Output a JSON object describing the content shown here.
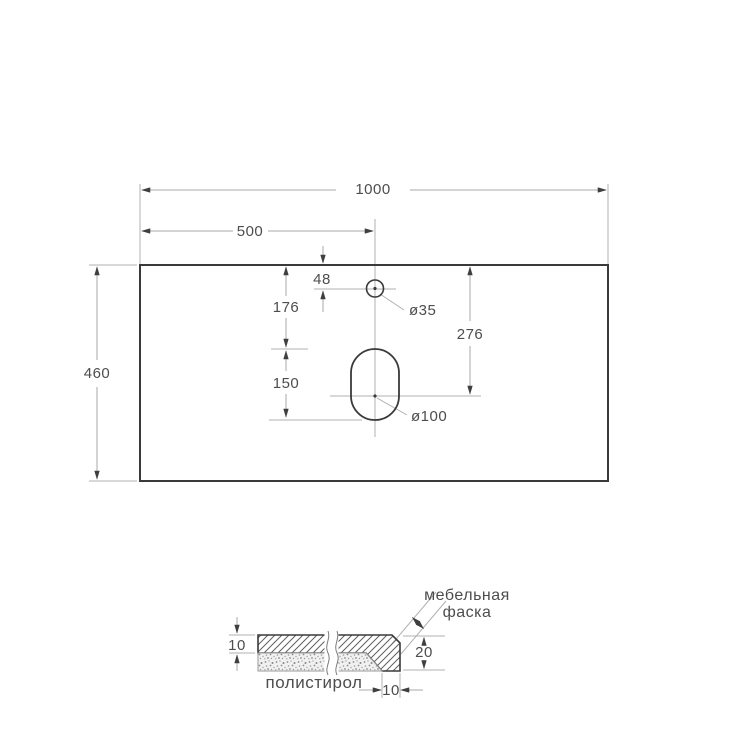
{
  "drawing": {
    "kind": "countertop-dimension-drawing",
    "colors": {
      "outline": "#3a3a3a",
      "dim_line": "#b0b0b0",
      "arrow": "#3f3f3f",
      "text": "#4d4d4d",
      "background": "#ffffff"
    },
    "top_view": {
      "overall_width": "1000",
      "center_offset": "500",
      "depth": "460",
      "faucet_hole_offset": "48",
      "drain_top_offset": "176",
      "drain_slot_length": "150",
      "drain_center_offset": "276",
      "faucet_hole_diameter": "ø35",
      "drain_hole_diameter": "ø100"
    },
    "section_view": {
      "top_thickness": "10",
      "edge_height": "20",
      "edge_width": "10",
      "filler_label": "полистирол",
      "chamfer_label_line1": "мебельная",
      "chamfer_label_line2": "фаска"
    }
  }
}
